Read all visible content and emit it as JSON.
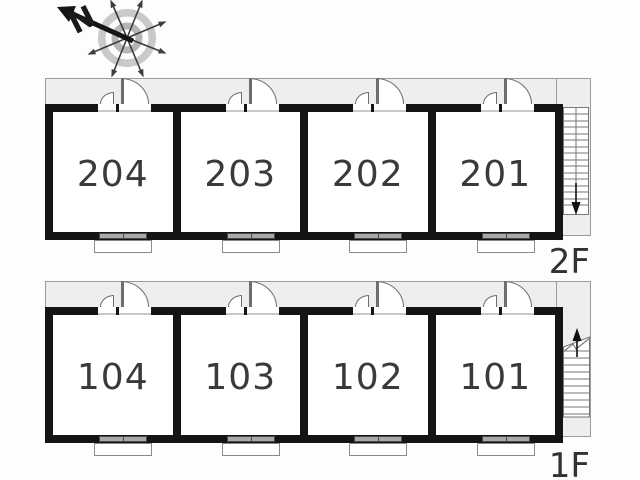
{
  "compass": {
    "north_label": "N"
  },
  "floors": [
    {
      "label": "2F",
      "rooms": [
        {
          "number": "204"
        },
        {
          "number": "203"
        },
        {
          "number": "202"
        },
        {
          "number": "201"
        }
      ],
      "stairs": {
        "direction": "down"
      }
    },
    {
      "label": "1F",
      "rooms": [
        {
          "number": "104"
        },
        {
          "number": "103"
        },
        {
          "number": "102"
        },
        {
          "number": "101"
        }
      ],
      "stairs": {
        "direction": "up"
      }
    }
  ],
  "colors": {
    "wall": "#141414",
    "corridor_fill": "#eeeeec",
    "outline": "#777777",
    "text": "#3a3a3a"
  }
}
